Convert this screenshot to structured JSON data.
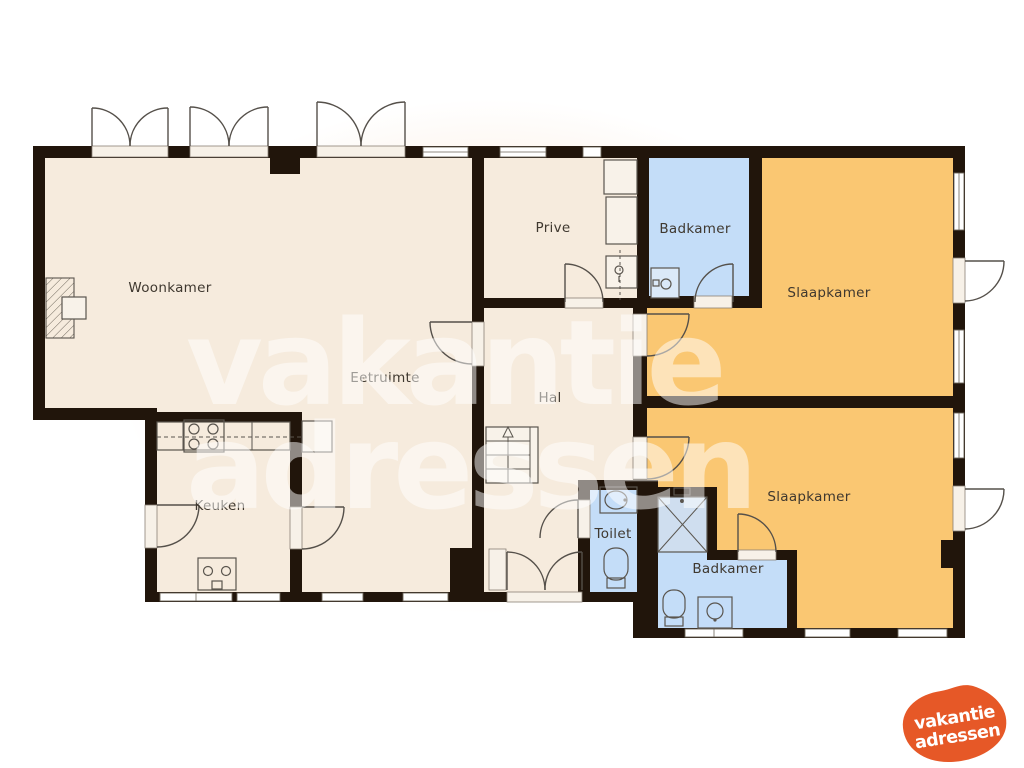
{
  "rooms": [
    {
      "id": "woonkamer",
      "label": "Woonkamer"
    },
    {
      "id": "eetruimte",
      "label": "Eetruimte"
    },
    {
      "id": "prive",
      "label": "Prive"
    },
    {
      "id": "badkamer_boven",
      "label": "Badkamer"
    },
    {
      "id": "slaapkamer_boven",
      "label": "Slaapkamer"
    },
    {
      "id": "hal",
      "label": "Hal"
    },
    {
      "id": "keuken",
      "label": "Keuken"
    },
    {
      "id": "toilet",
      "label": "Toilet"
    },
    {
      "id": "badkamer_beneden",
      "label": "Badkamer"
    },
    {
      "id": "slaapkamer_beneden",
      "label": "Slaapkamer"
    }
  ],
  "watermark": {
    "line1": "vakantie",
    "line2": "adressen"
  },
  "logo": {
    "line1": "vakantie",
    "line2": "adressen"
  },
  "colors": {
    "wall": "#21150b",
    "floor_living": "#f6ebdd",
    "floor_bath": "#c4ddf8",
    "floor_bedroom": "#fac772",
    "shower": "#cfdeef",
    "background_blob": "#f9e5d4",
    "logo_orange": "#e65827",
    "watermark_white": "rgba(255,255,255,0.5)",
    "label_text": "#3f382f"
  }
}
